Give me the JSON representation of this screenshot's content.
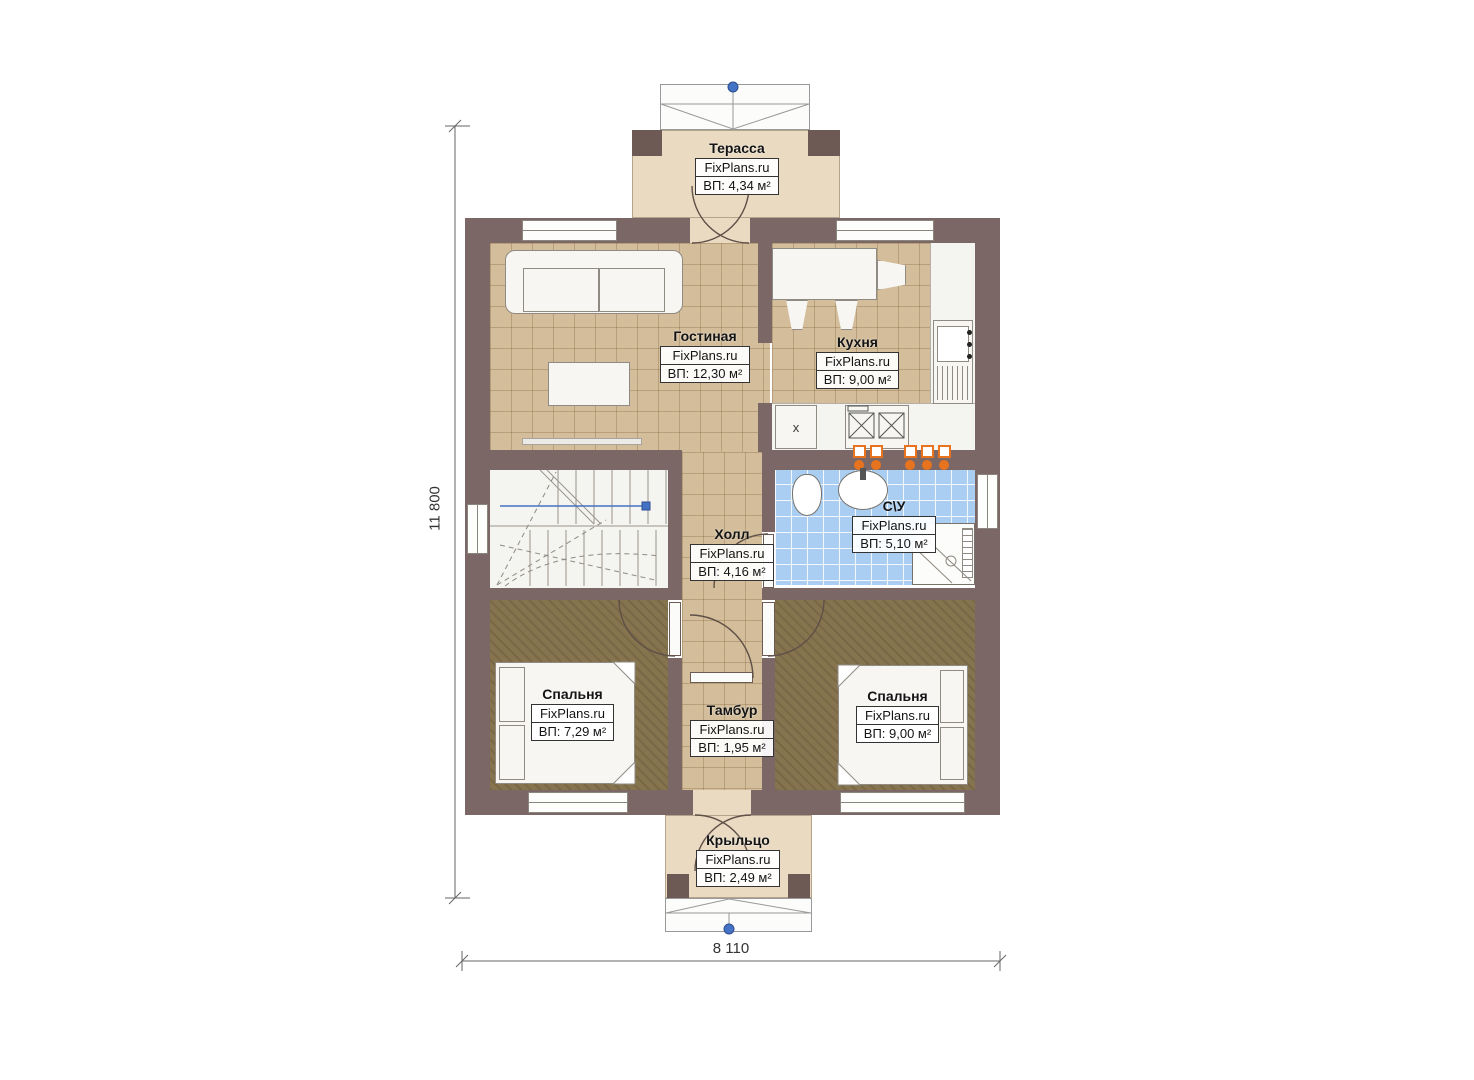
{
  "plan": {
    "brand": "FixPlans.ru",
    "rooms": [
      {
        "id": "terrace",
        "name": "Терасса",
        "brand": "FixPlans.ru",
        "area": "ВП: 4,34 м²"
      },
      {
        "id": "living",
        "name": "Гостиная",
        "brand": "FixPlans.ru",
        "area": "ВП: 12,30 м²"
      },
      {
        "id": "kitchen",
        "name": "Кухня",
        "brand": "FixPlans.ru",
        "area": "ВП: 9,00 м²"
      },
      {
        "id": "hall",
        "name": "Холл",
        "brand": "FixPlans.ru",
        "area": "ВП: 4,16 м²"
      },
      {
        "id": "bathroom",
        "name": "С\\У",
        "brand": "FixPlans.ru",
        "area": "ВП: 5,10 м²"
      },
      {
        "id": "bedroom-left",
        "name": "Спальня",
        "brand": "FixPlans.ru",
        "area": "ВП: 7,29 м²"
      },
      {
        "id": "vestibule",
        "name": "Тамбур",
        "brand": "FixPlans.ru",
        "area": "ВП: 1,95 м²"
      },
      {
        "id": "bedroom-right",
        "name": "Спальня",
        "brand": "FixPlans.ru",
        "area": "ВП: 9,00 м²"
      },
      {
        "id": "porch",
        "name": "Крыльцо",
        "brand": "FixPlans.ru",
        "area": "ВП: 2,49 м²"
      }
    ],
    "dimensions": {
      "height": "11 800",
      "width": "8 110"
    },
    "marks": {
      "cabinet": "x"
    },
    "colors": {
      "wall": "#7a6766",
      "tile": "#d3bd9a",
      "carpet": "#86744e",
      "bathroom_tile": "#a9cef2",
      "radiator": "#e8731e",
      "reference_blue": "#4472c4"
    }
  }
}
